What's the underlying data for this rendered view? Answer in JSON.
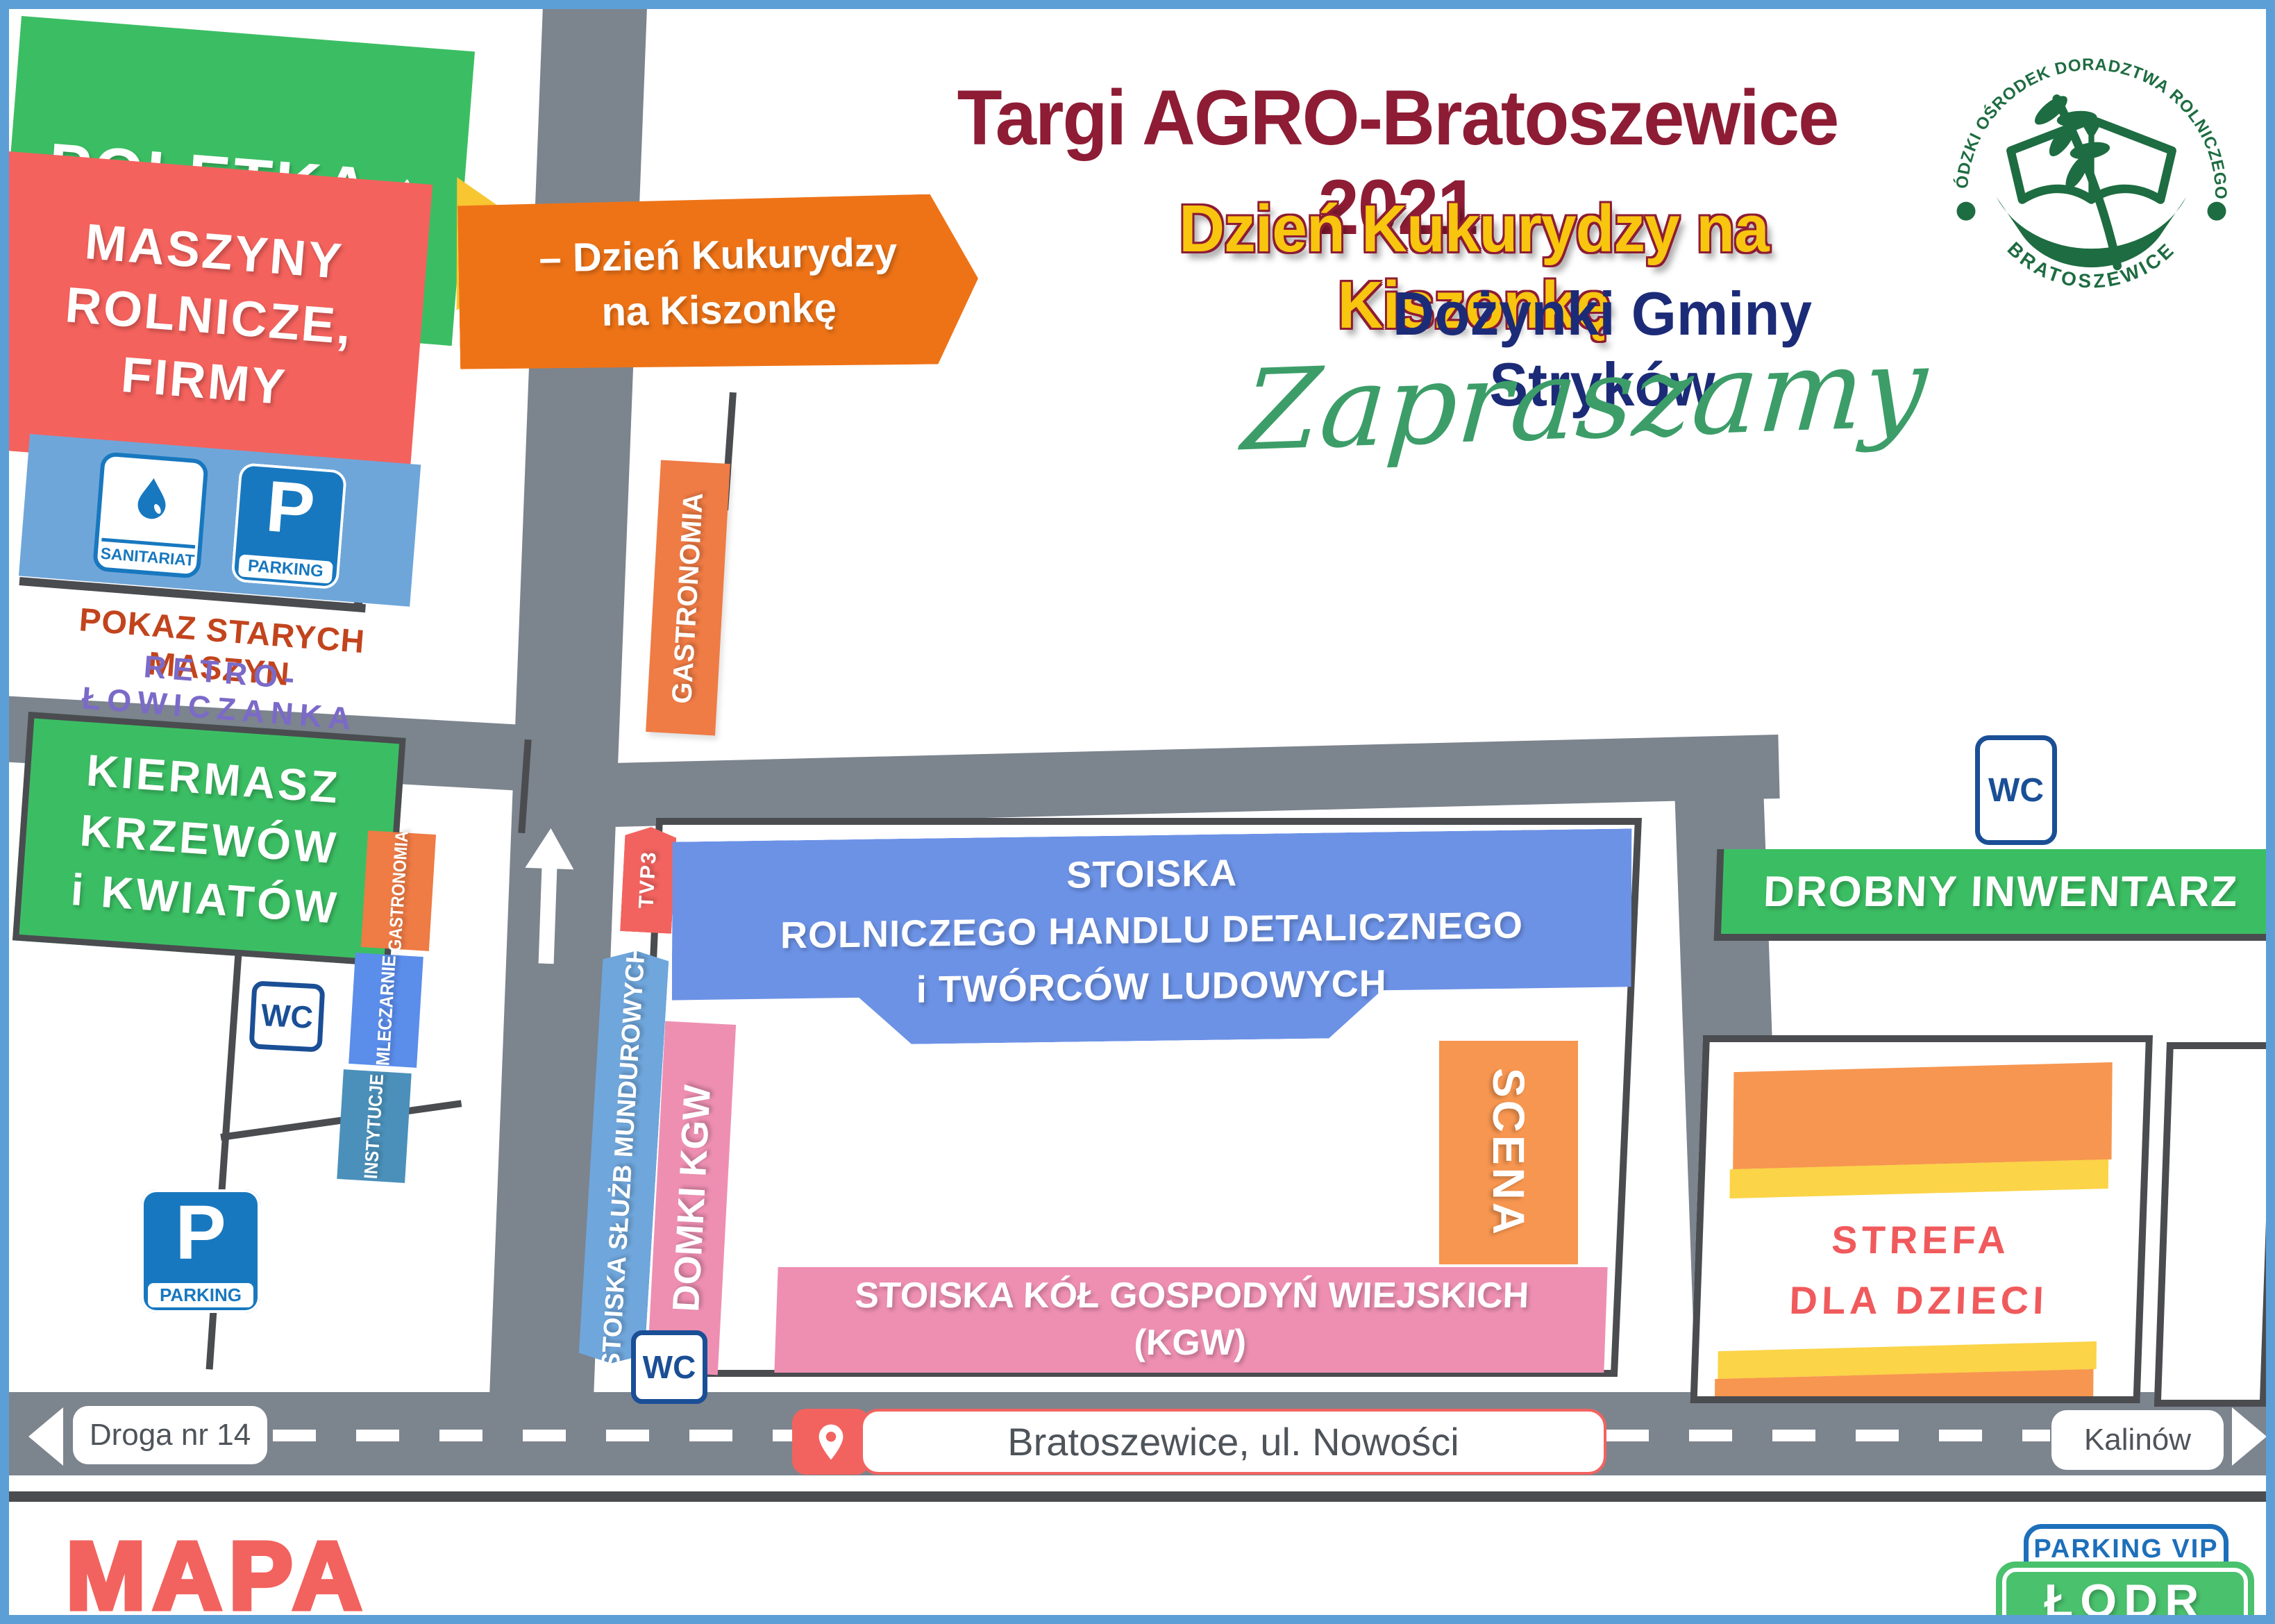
{
  "header": {
    "title": "Targi AGRO-Bratoszewice 2021",
    "subtitle": "Dzień Kukurydzy na Kiszonkę",
    "subtitle2": "Dożynki Gminy Stryków",
    "welcome_script": "Zapraszamy",
    "logo": {
      "arc_top": "ŁÓDZKI OŚRODEK DORADZTWA ROLNICZEGO",
      "arc_bottom": "BRATOSZEWICE"
    }
  },
  "areas": {
    "poletka": {
      "label": "POLETKA ↑",
      "color": "#3BBE63"
    },
    "maszyny": {
      "label": "MASZYNY\nROLNICZE,\nFIRMY",
      "color": "#F4625D"
    },
    "sanitariat": {
      "label": "SANITARIAT"
    },
    "parking_small": {
      "label": "PARKING"
    },
    "parking_letter": "P",
    "pokaz": {
      "label": "POKAZ STARYCH MASZYN",
      "color": "#C2441D"
    },
    "retro": {
      "label": "RETRO-ŁOWICZANKA",
      "color": "#7B6AC8"
    },
    "kiermasz": {
      "label": "KIERMASZ\nKRZEWÓW\ni KWIATÓW",
      "color": "#3BBE63"
    },
    "dzien_banner": {
      "label": "– Dzień Kukurydzy\nna Kiszonkę",
      "color": "#EE7317"
    },
    "gastronomia_mid": {
      "label": "GASTRONOMIA",
      "color": "#EF7B45"
    },
    "gastronomia_left": {
      "label": "GASTRONOMIA",
      "color": "#EF7B45"
    },
    "mleczarnie": {
      "label": "MLECZARNIE",
      "color": "#5B8DEB"
    },
    "instytucje": {
      "label": "INSTYTUCJE",
      "color": "#4A90BA"
    },
    "tvp3": {
      "label": "TVP3",
      "color": "#F2635F"
    },
    "stoiska_rhd": {
      "label": "STOISKA\nROLNICZEGO HANDLU DETALICZNEGO\ni TWÓRCÓW LUDOWYCH",
      "color": "#6C92E6"
    },
    "sluzby": {
      "label": "STOISKA SŁUŻB MUNDUROWYCH",
      "color": "#6FA6DB"
    },
    "domki": {
      "label": "DOMKI KGW",
      "color": "#EE8FB2"
    },
    "scena": {
      "label": "SCENA",
      "color": "#F79650"
    },
    "kgw": {
      "label": "STOISKA KÓŁ GOSPODYŃ WIEJSKICH\n(KGW)",
      "color": "#EE8FB2"
    },
    "drobny": {
      "label": "DROBNY INWENTARZ",
      "color": "#3BBE63"
    },
    "strefa": {
      "label": "STREFA\nDLA DZIECI",
      "color": "#F05A5C"
    }
  },
  "icons": {
    "wc": "WC"
  },
  "roads": {
    "droga": "Droga nr 14",
    "miejsce": "Bratoszewice, ul. Nowości",
    "kalinow": "Kalinów"
  },
  "footer": {
    "mapa": "MAPA",
    "parking_vip": "PARKING VIP",
    "lodr": "ŁODR"
  },
  "colors": {
    "road_gray": "#7C848E",
    "plot_line": "#4A4C50",
    "title_maroon": "#8D1C34",
    "title_yellow": "#F8C50F",
    "title_navy": "#1C2B77",
    "script_green": "#3C9D68",
    "logo_green": "#1E6C41",
    "page_border_blue": "#5C9FD6",
    "sign_blue": "#1878BF",
    "mapa_salmon": "#F2625E"
  }
}
